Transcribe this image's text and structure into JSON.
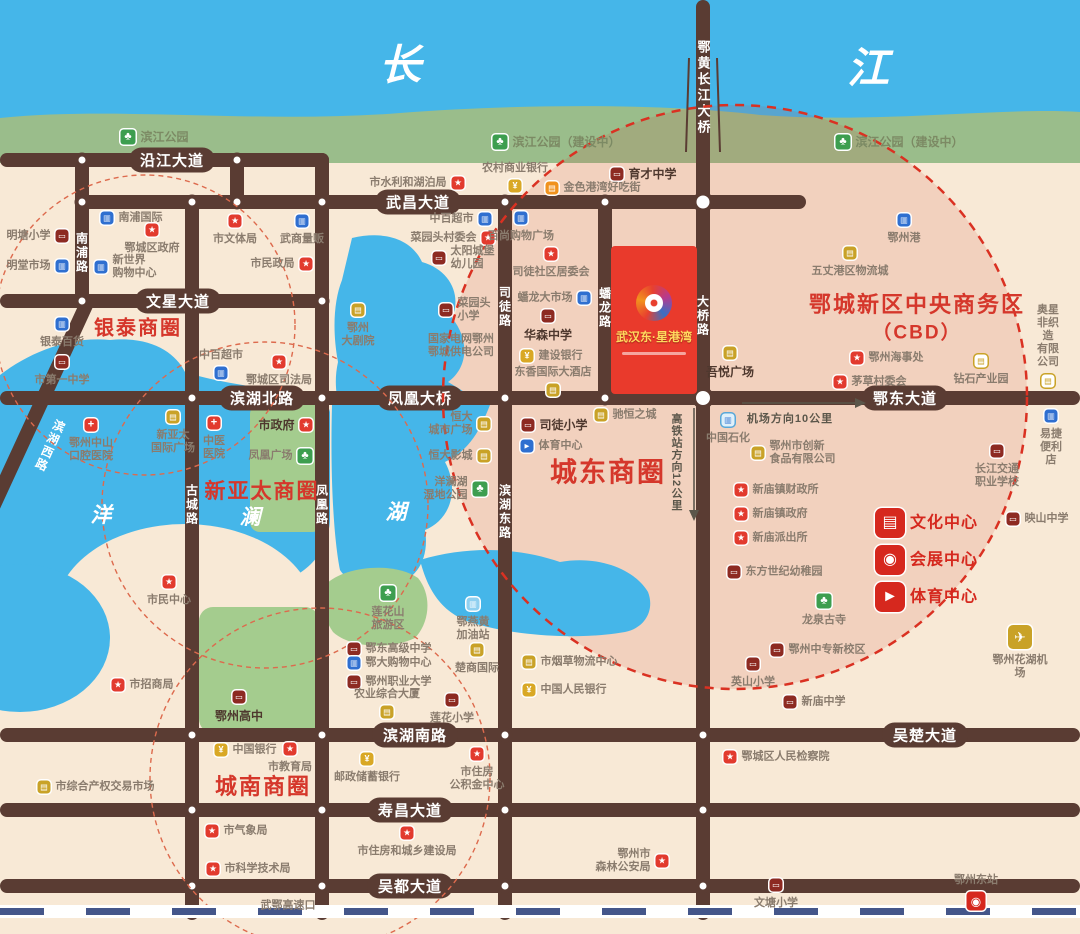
{
  "project": {
    "title": "武汉东·星港湾"
  },
  "colors": {
    "road": "#5a3c33",
    "river": "#45b6e9",
    "bank_green": "#9abd8b",
    "land": "#f8e9d6",
    "cbd_red": "#e93a2c",
    "accent_red": "#d5372b"
  },
  "map": {
    "region_labels": [
      {
        "t": "长",
        "x": 400,
        "y": 62,
        "cls": "river-char"
      },
      {
        "t": "江",
        "x": 868,
        "y": 65,
        "cls": "river-char"
      },
      {
        "t": "洋",
        "x": 101,
        "y": 514,
        "cls": "lake-char"
      },
      {
        "t": "澜",
        "x": 250,
        "y": 516,
        "cls": "lake-char"
      },
      {
        "t": "湖",
        "x": 396,
        "y": 511,
        "cls": "lake-char"
      },
      {
        "t": "银泰商圈",
        "x": 138,
        "y": 326,
        "cls": "biz",
        "fs": 20
      },
      {
        "t": "新亚太商圈",
        "x": 262,
        "y": 490,
        "cls": "biz",
        "fs": 21
      },
      {
        "t": "城南商圈",
        "x": 263,
        "y": 785,
        "cls": "biz",
        "fs": 22
      },
      {
        "t": "城东商圈",
        "x": 608,
        "y": 470,
        "cls": "biz",
        "fs": 27
      },
      {
        "t": "鄂城新区中央商务区",
        "x": 917,
        "y": 303,
        "cls": "biz",
        "fs": 22
      },
      {
        "t": "（CBD）",
        "x": 917,
        "y": 331,
        "cls": "biz",
        "fs": 19
      }
    ],
    "roads_h": [
      {
        "y": 160,
        "x1": 0,
        "x2": 329
      },
      {
        "y": 202,
        "x1": 82,
        "x2": 806
      },
      {
        "y": 301,
        "x1": 0,
        "x2": 329
      },
      {
        "y": 398,
        "x1": 0,
        "x2": 1080
      },
      {
        "y": 735,
        "x1": 0,
        "x2": 1080
      },
      {
        "y": 810,
        "x1": 0,
        "x2": 1080
      },
      {
        "y": 886,
        "x1": 0,
        "x2": 1080
      }
    ],
    "roads_v": [
      {
        "x": 82,
        "y1": 153,
        "y2": 308
      },
      {
        "x": 237,
        "y1": 153,
        "y2": 209
      },
      {
        "x": 192,
        "y1": 195,
        "y2": 920
      },
      {
        "x": 322,
        "y1": 153,
        "y2": 920
      },
      {
        "x": 505,
        "y1": 195,
        "y2": 920
      },
      {
        "x": 605,
        "y1": 195,
        "y2": 405
      },
      {
        "x": 703,
        "y1": 0,
        "y2": 920
      }
    ],
    "road_labels": [
      {
        "x": 172,
        "y": 160,
        "t": "沿江大道"
      },
      {
        "x": 418,
        "y": 202,
        "t": "武昌大道"
      },
      {
        "x": 178,
        "y": 301,
        "t": "文星大道"
      },
      {
        "x": 262,
        "y": 398,
        "t": "滨湖北路"
      },
      {
        "x": 420,
        "y": 398,
        "t": "凤凰大桥"
      },
      {
        "x": 905,
        "y": 398,
        "t": "鄂东大道"
      },
      {
        "x": 415,
        "y": 735,
        "t": "滨湖南路"
      },
      {
        "x": 925,
        "y": 735,
        "t": "吴楚大道"
      },
      {
        "x": 410,
        "y": 810,
        "t": "寿昌大道"
      },
      {
        "x": 410,
        "y": 886,
        "t": "吴都大道"
      }
    ],
    "road_labels_vertical": [
      {
        "x": 82,
        "y": 253,
        "t": "南浦路"
      },
      {
        "x": 192,
        "y": 505,
        "t": "古城路"
      },
      {
        "x": 322,
        "y": 505,
        "t": "凤凰路"
      },
      {
        "x": 505,
        "y": 307,
        "t": "司徒路"
      },
      {
        "x": 505,
        "y": 512,
        "t": "滨湖东路"
      },
      {
        "x": 605,
        "y": 308,
        "t": "蟠龙路"
      },
      {
        "x": 703,
        "y": 316,
        "t": "大桥路"
      },
      {
        "x": 703,
        "y": 88,
        "t": "鄂黄长江大桥",
        "cls": "bridge"
      },
      {
        "x": 50,
        "y": 446,
        "t": "滨湖西路",
        "rot": 24
      }
    ],
    "direction_hints": [
      {
        "t": "高铁站方向12公里",
        "x": 676,
        "y": 462,
        "vertical": true
      },
      {
        "t": "机场方向10公里",
        "x": 790,
        "y": 418,
        "vertical": false
      }
    ],
    "nodes": [
      [
        82,
        160
      ],
      [
        237,
        160
      ],
      [
        82,
        202
      ],
      [
        192,
        202
      ],
      [
        237,
        202
      ],
      [
        322,
        202
      ],
      [
        505,
        202
      ],
      [
        605,
        202
      ],
      [
        703,
        202,
        21
      ],
      [
        82,
        301
      ],
      [
        192,
        301
      ],
      [
        322,
        301
      ],
      [
        192,
        398
      ],
      [
        322,
        398
      ],
      [
        505,
        398
      ],
      [
        605,
        398
      ],
      [
        703,
        398,
        22
      ],
      [
        192,
        735
      ],
      [
        322,
        735
      ],
      [
        505,
        735
      ],
      [
        703,
        735
      ],
      [
        192,
        810
      ],
      [
        322,
        810
      ],
      [
        505,
        810
      ],
      [
        703,
        810
      ],
      [
        192,
        886
      ],
      [
        322,
        886
      ],
      [
        505,
        886
      ],
      [
        703,
        886
      ]
    ],
    "icon_glyphs": {
      "gov": "★",
      "school": "▭",
      "blue": "▥",
      "bank": "¥",
      "gold": "▤",
      "gold-o": "▤",
      "orange": "▤",
      "tree": "♣",
      "hosp": "+",
      "plane": "✈",
      "station": "◉",
      "gas": "▥",
      "petro": "▥",
      "sportb": "►",
      "culture": "▤",
      "expo": "◉",
      "sportr": "►"
    },
    "pois": [
      {
        "x": 128,
        "y": 137,
        "i": "tree",
        "t": "滨江公园",
        "p": "r",
        "c": "park"
      },
      {
        "x": 500,
        "y": 142,
        "i": "tree",
        "t": "滨江公园（建设中）",
        "p": "r",
        "c": "park"
      },
      {
        "x": 843,
        "y": 142,
        "i": "tree",
        "t": "滨江公园（建设中）",
        "p": "r",
        "c": "park"
      },
      {
        "x": 458,
        "y": 183,
        "i": "gov",
        "t": "市水利和湖泊局",
        "p": "l"
      },
      {
        "x": 515,
        "y": 186,
        "i": "bank",
        "t": "农村商业银行",
        "p": "t"
      },
      {
        "x": 617,
        "y": 174,
        "i": "school",
        "t": "育才中学",
        "p": "r",
        "b": 1
      },
      {
        "x": 552,
        "y": 188,
        "i": "orange",
        "t": "金色港湾好吃街",
        "p": "r"
      },
      {
        "x": 107,
        "y": 218,
        "i": "blue",
        "t": "南浦国际",
        "p": "r"
      },
      {
        "x": 152,
        "y": 230,
        "i": "gov",
        "t": "鄂城区政府",
        "p": "b"
      },
      {
        "x": 62,
        "y": 236,
        "i": "school",
        "t": "明塘小学",
        "p": "l"
      },
      {
        "x": 62,
        "y": 266,
        "i": "blue",
        "t": "明堂市场",
        "p": "l"
      },
      {
        "x": 101,
        "y": 267,
        "i": "blue",
        "t": "新世界\n购物中心",
        "p": "r"
      },
      {
        "x": 235,
        "y": 221,
        "i": "gov",
        "t": "市文体局",
        "p": "b"
      },
      {
        "x": 302,
        "y": 221,
        "i": "blue",
        "t": "武商量贩",
        "p": "b"
      },
      {
        "x": 306,
        "y": 264,
        "i": "gov",
        "t": "市民政局",
        "p": "l"
      },
      {
        "x": 485,
        "y": 219,
        "i": "blue",
        "t": "中百超市",
        "p": "l"
      },
      {
        "x": 488,
        "y": 238,
        "i": "gov",
        "t": "菜园头村委会",
        "p": "l"
      },
      {
        "x": 439,
        "y": 258,
        "i": "school",
        "t": "太阳城堡\n幼儿园",
        "p": "r"
      },
      {
        "x": 521,
        "y": 218,
        "i": "blue",
        "t": "百尚购物广场",
        "p": "b"
      },
      {
        "x": 551,
        "y": 254,
        "i": "gov",
        "t": "司徒社区居委会",
        "p": "b"
      },
      {
        "x": 584,
        "y": 298,
        "i": "blue",
        "t": "蟠龙大市场",
        "p": "l"
      },
      {
        "x": 548,
        "y": 316,
        "i": "school",
        "t": "华森中学",
        "p": "b",
        "b": 1
      },
      {
        "x": 446,
        "y": 310,
        "i": "school",
        "t": "菜园头\n小学",
        "p": "r"
      },
      {
        "x": 461,
        "y": 346,
        "i": null,
        "t": "国家电网鄂州\n鄂城供电公司",
        "p": "c"
      },
      {
        "x": 527,
        "y": 356,
        "i": "bank",
        "t": "建设银行",
        "p": "r"
      },
      {
        "x": 553,
        "y": 390,
        "i": "gold",
        "t": "东香国际大酒店",
        "p": "t"
      },
      {
        "x": 358,
        "y": 310,
        "i": "gold",
        "t": "鄂州\n大剧院",
        "p": "b"
      },
      {
        "x": 484,
        "y": 424,
        "i": "gold",
        "t": "恒大\n城市广场",
        "p": "l"
      },
      {
        "x": 484,
        "y": 456,
        "i": "gold",
        "t": "恒大影城",
        "p": "l"
      },
      {
        "x": 480,
        "y": 489,
        "i": "tree",
        "t": "洋澜湖\n湿地公园",
        "p": "l"
      },
      {
        "x": 528,
        "y": 425,
        "i": "school",
        "t": "司徒小学",
        "p": "r",
        "b": 1
      },
      {
        "x": 527,
        "y": 446,
        "i": "sportb",
        "t": "体育中心",
        "p": "r"
      },
      {
        "x": 601,
        "y": 415,
        "i": "gold",
        "t": "驰恒之城",
        "p": "r"
      },
      {
        "x": 730,
        "y": 353,
        "i": "gold",
        "t": "吾悦广场",
        "p": "b",
        "b": 1
      },
      {
        "x": 850,
        "y": 253,
        "i": "gold",
        "t": "五丈港区物流城",
        "p": "b"
      },
      {
        "x": 904,
        "y": 220,
        "i": "blue",
        "t": "鄂州港",
        "p": "b"
      },
      {
        "x": 857,
        "y": 358,
        "i": "gov",
        "t": "鄂州海事处",
        "p": "r"
      },
      {
        "x": 840,
        "y": 382,
        "i": "gov",
        "t": "茅草村委会",
        "p": "r"
      },
      {
        "x": 981,
        "y": 361,
        "i": "gold-o",
        "t": "钻石产业园",
        "p": "b"
      },
      {
        "x": 1048,
        "y": 381,
        "i": "gold-o",
        "t": "奥星非织造\n有限公司",
        "p": "t"
      },
      {
        "x": 728,
        "y": 420,
        "i": "petro",
        "t": "中国石化",
        "p": "b"
      },
      {
        "x": 758,
        "y": 453,
        "i": "gold",
        "t": "鄂州市创新\n食品有限公司",
        "p": "r"
      },
      {
        "x": 741,
        "y": 490,
        "i": "gov",
        "t": "新庙镇财政所",
        "p": "r"
      },
      {
        "x": 741,
        "y": 514,
        "i": "gov",
        "t": "新庙镇政府",
        "p": "r"
      },
      {
        "x": 741,
        "y": 538,
        "i": "gov",
        "t": "新庙派出所",
        "p": "r"
      },
      {
        "x": 734,
        "y": 572,
        "i": "school",
        "t": "东方世纪幼稚园",
        "p": "r"
      },
      {
        "x": 824,
        "y": 601,
        "i": "tree",
        "t": "龙泉古寺",
        "p": "b"
      },
      {
        "x": 890,
        "y": 523,
        "i": "culture",
        "t": "文化中心",
        "p": "r",
        "c": "feat"
      },
      {
        "x": 890,
        "y": 560,
        "i": "expo",
        "t": "会展中心",
        "p": "r",
        "c": "feat"
      },
      {
        "x": 890,
        "y": 597,
        "i": "sportr",
        "t": "体育中心",
        "p": "r",
        "c": "feat"
      },
      {
        "x": 1051,
        "y": 416,
        "i": "blue",
        "t": "易捷便利店",
        "p": "b"
      },
      {
        "x": 997,
        "y": 451,
        "i": "school",
        "t": "长江交通\n职业学校",
        "p": "b"
      },
      {
        "x": 1013,
        "y": 519,
        "i": "school",
        "t": "映山中学",
        "p": "r"
      },
      {
        "x": 777,
        "y": 650,
        "i": "school",
        "t": "鄂州中专新校区",
        "p": "r"
      },
      {
        "x": 753,
        "y": 664,
        "i": "school",
        "t": "英山小学",
        "p": "b"
      },
      {
        "x": 790,
        "y": 702,
        "i": "school",
        "t": "新庙中学",
        "p": "r"
      },
      {
        "x": 1020,
        "y": 637,
        "i": "plane",
        "t": "鄂州花湖机场",
        "p": "b"
      },
      {
        "x": 730,
        "y": 757,
        "i": "gov",
        "t": "鄂城区人民检察院",
        "p": "r"
      },
      {
        "x": 776,
        "y": 885,
        "i": "school",
        "t": "文塘小学",
        "p": "b"
      },
      {
        "x": 976,
        "y": 901,
        "i": "station",
        "t": "鄂州东站",
        "p": "t"
      },
      {
        "x": 529,
        "y": 662,
        "i": "gold",
        "t": "市烟草物流中心",
        "p": "r"
      },
      {
        "x": 529,
        "y": 690,
        "i": "bank",
        "t": "中国人民银行",
        "p": "r"
      },
      {
        "x": 388,
        "y": 593,
        "i": "tree",
        "t": "莲花山\n旅游区",
        "p": "b"
      },
      {
        "x": 473,
        "y": 604,
        "i": "gas",
        "t": "鄂燕黄\n加油站",
        "p": "b"
      },
      {
        "x": 354,
        "y": 649,
        "i": "school",
        "t": "鄂东高级中学",
        "p": "r"
      },
      {
        "x": 354,
        "y": 663,
        "i": "blue",
        "t": "鄂大购物中心",
        "p": "r"
      },
      {
        "x": 354,
        "y": 682,
        "i": "school",
        "t": "鄂州职业大学",
        "p": "r"
      },
      {
        "x": 387,
        "y": 712,
        "i": "gold",
        "t": "农业综合大厦",
        "p": "t"
      },
      {
        "x": 477,
        "y": 650,
        "i": "gold",
        "t": "楚商国际",
        "p": "b"
      },
      {
        "x": 452,
        "y": 700,
        "i": "school",
        "t": "莲花小学",
        "p": "b"
      },
      {
        "x": 221,
        "y": 750,
        "i": "bank",
        "t": "中国银行",
        "p": "r"
      },
      {
        "x": 290,
        "y": 749,
        "i": "gov",
        "t": "市教育局",
        "p": "b"
      },
      {
        "x": 367,
        "y": 759,
        "i": "bank",
        "t": "邮政储蓄银行",
        "p": "b"
      },
      {
        "x": 477,
        "y": 754,
        "i": "gov",
        "t": "市住房\n公积金中心",
        "p": "b"
      },
      {
        "x": 44,
        "y": 787,
        "i": "gold",
        "t": "市综合产权交易市场",
        "p": "r"
      },
      {
        "x": 118,
        "y": 685,
        "i": "gov",
        "t": "市招商局",
        "p": "r"
      },
      {
        "x": 239,
        "y": 697,
        "i": "school",
        "t": "鄂州高中",
        "p": "b",
        "b": 1
      },
      {
        "x": 212,
        "y": 831,
        "i": "gov",
        "t": "市气象局",
        "p": "r"
      },
      {
        "x": 213,
        "y": 869,
        "i": "gov",
        "t": "市科学技术局",
        "p": "r"
      },
      {
        "x": 407,
        "y": 833,
        "i": "gov",
        "t": "市住房和城乡建设局",
        "p": "b"
      },
      {
        "x": 288,
        "y": 906,
        "i": null,
        "t": "武鄂高速口",
        "p": "c"
      },
      {
        "x": 662,
        "y": 861,
        "i": "gov",
        "t": "鄂州市\n森林公安局",
        "p": "l"
      },
      {
        "x": 62,
        "y": 324,
        "i": "blue",
        "t": "银泰百货",
        "p": "b"
      },
      {
        "x": 62,
        "y": 362,
        "i": "school",
        "t": "市第一中学",
        "p": "b"
      },
      {
        "x": 221,
        "y": 373,
        "i": "blue",
        "t": "中百超市",
        "p": "t"
      },
      {
        "x": 279,
        "y": 362,
        "i": "gov",
        "t": "鄂城区司法局",
        "p": "b"
      },
      {
        "x": 91,
        "y": 425,
        "i": "hosp",
        "t": "鄂州中山\n口腔医院",
        "p": "b"
      },
      {
        "x": 173,
        "y": 417,
        "i": "gold",
        "t": "新亚太\n国际广场",
        "p": "b"
      },
      {
        "x": 214,
        "y": 423,
        "i": "hosp",
        "t": "中医\n医院",
        "p": "b"
      },
      {
        "x": 306,
        "y": 425,
        "i": "gov",
        "t": "市政府",
        "p": "l",
        "b": 1
      },
      {
        "x": 305,
        "y": 456,
        "i": "tree",
        "t": "凤凰广场",
        "p": "l"
      },
      {
        "x": 169,
        "y": 582,
        "i": "gov",
        "t": "市民中心",
        "p": "b"
      }
    ]
  }
}
